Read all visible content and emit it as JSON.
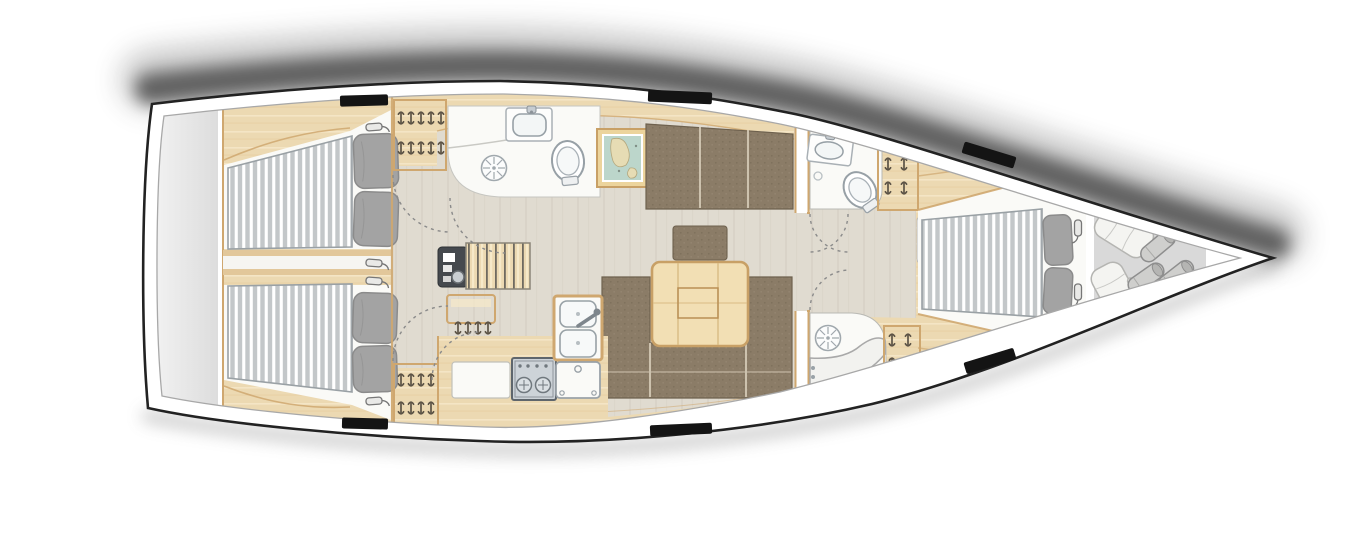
{
  "diagram": {
    "name": "Sailing yacht interior deck plan, bow pointing right",
    "type": "yacht-floor-plan",
    "orientation": "bow-right",
    "rooms": [
      {
        "id": "stern-platform",
        "label": "stern transom platform"
      },
      {
        "id": "aft-cabin-port",
        "label": "aft double cabin (port)"
      },
      {
        "id": "aft-cabin-starboard",
        "label": "aft double cabin (starboard)"
      },
      {
        "id": "engine-access",
        "label": "engine access passage between aft cabins"
      },
      {
        "id": "aft-head",
        "label": "aft head with washbasin, toilet and shower drain"
      },
      {
        "id": "companionway",
        "label": "companionway steps with instrument panel"
      },
      {
        "id": "salon",
        "label": "salon with U-shaped settee and folding table"
      },
      {
        "id": "galley",
        "label": "galley with stove, double sink and oven"
      },
      {
        "id": "forward-head",
        "label": "forward head with washbasin and toilet"
      },
      {
        "id": "forward-shower",
        "label": "separate forward shower room with bench"
      },
      {
        "id": "forward-cabin",
        "label": "forward double cabin"
      },
      {
        "id": "sail-locker",
        "label": "bow sail locker with sail bags and fenders"
      },
      {
        "id": "anchor-locker",
        "label": "anchor locker at bow tip"
      }
    ],
    "furniture": {
      "double_beds": 3,
      "pillows": 6,
      "hanging_lockers": 4,
      "reading_lights": 6,
      "salon_table_with_folding_leaf": 1,
      "settee_sections": 3,
      "stove_burners": 2,
      "galley_sinks": 2,
      "oven": 1,
      "toilets": 2,
      "washbasins": 3,
      "shower_drains": 3,
      "framed_chart_picture": 1,
      "companionway_steps": 1,
      "instrument_panel": 1,
      "deck_hatches": 6,
      "sail_bags": 2,
      "fenders": 3,
      "door_swings": 7
    }
  },
  "colors": {
    "hullStroke": "#222222",
    "hullFill": "#ffffff",
    "innerLine": "#a8a8a8",
    "wood": "#ecd9b2",
    "woodLight": "#f6e9c9",
    "woodDark": "#dfc193",
    "woodTrim": "#cfa76f",
    "floor": "#e0dbd0",
    "floorStreak": "#d2ccbf",
    "white": "#fafaf7",
    "upholstery": "#8b7c67",
    "upholsterySeam": "#cdc2ae",
    "upholsteryDark": "#6e614e",
    "mattressBase": "#c3c7c9",
    "mattressStripe": "#ffffff",
    "mattressEdge": "#9aa1a5",
    "pillow": "#a3a3a3",
    "pillowEdge": "#8b8b8b",
    "fixtureLine": "#97a0a6",
    "steel": "#cdd3d8",
    "panelDark": "#45494e",
    "hatch": "#141414",
    "sternGray": "#e7e7e7",
    "bowGray": "#d9d9d9",
    "mapWater": "#bcd6cb",
    "mapLand": "#e6dcb4",
    "hanger": "#5c5346",
    "doorArc": "#8a8a8a"
  }
}
